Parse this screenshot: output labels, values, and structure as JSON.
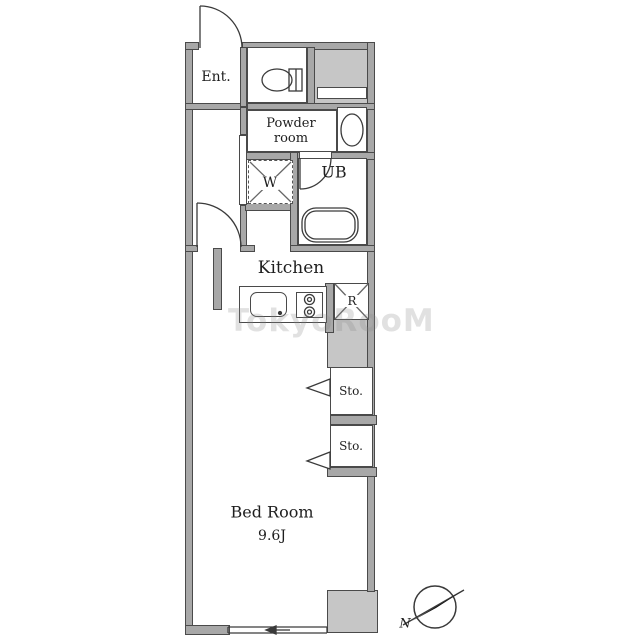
{
  "rooms": {
    "entrance": "Ent.",
    "powder_line1": "Powder",
    "powder_line2": "room",
    "washer": "W",
    "unit_bath": "UB",
    "kitchen": "Kitchen",
    "refrigerator": "R",
    "storage": [
      "Sto.",
      "Sto."
    ],
    "bedroom": "Bed Room",
    "bedroom_size": "9.6J"
  },
  "compass": {
    "north_label": "N"
  },
  "watermark": {
    "text": "TokyoRooM"
  },
  "colors": {
    "wall": "#a8a8a8",
    "zone": "#c6c6c6",
    "outline": "#4a4a4a",
    "text": "#1e1e1e",
    "watermark": "#8a8a8a"
  }
}
